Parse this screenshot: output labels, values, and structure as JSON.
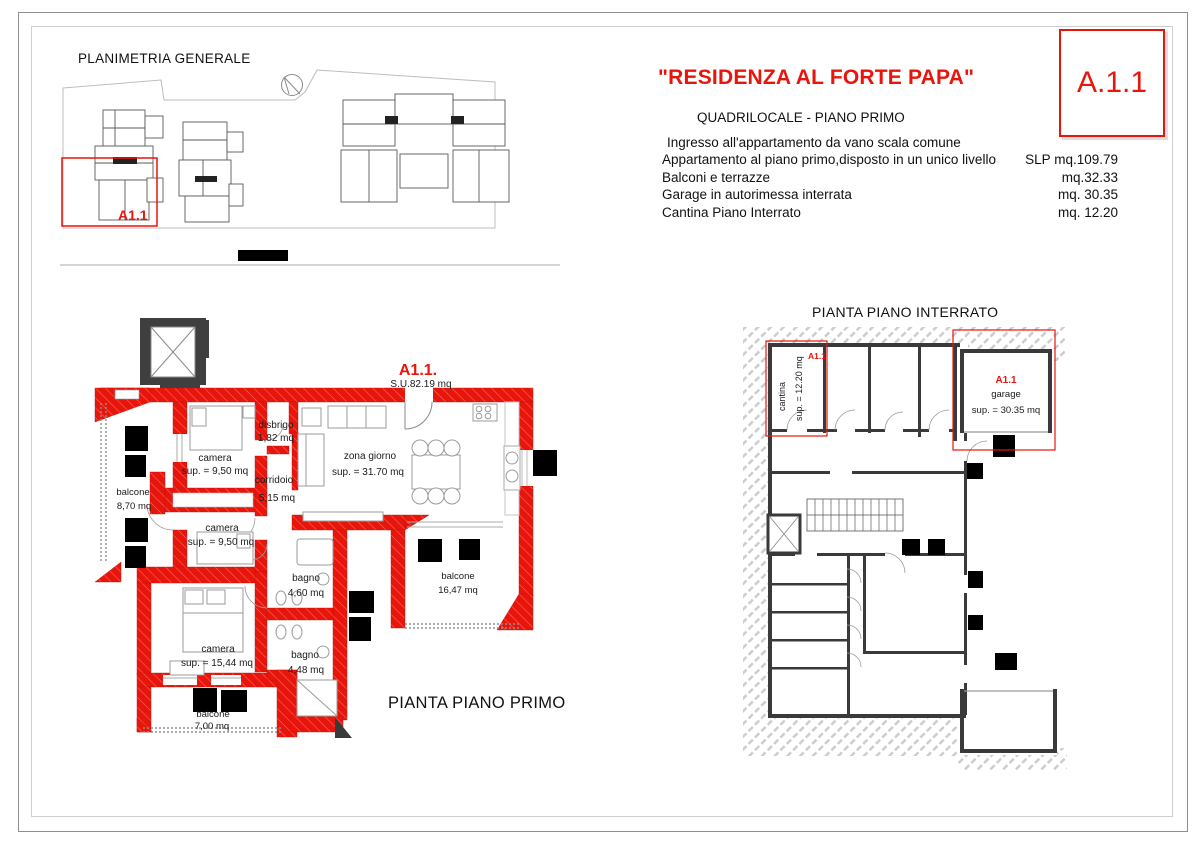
{
  "header": {
    "title": "\"RESIDENZA AL FORTE PAPA\"",
    "subtitle": "QUADRILOCALE - PIANO PRIMO",
    "unit_code": "A.1.1",
    "lines": [
      {
        "text": "Ingresso all'appartamento da vano scala comune",
        "value": ""
      },
      {
        "text": "Appartamento al piano primo,disposto in un unico livello",
        "value": "SLP mq.109.79"
      },
      {
        "text": "Balconi e terrazze",
        "value": "mq.32.33"
      },
      {
        "text": "Garage in autorimessa interrata",
        "value": "mq. 30.35"
      },
      {
        "text": "Cantina Piano Interrato",
        "value": "mq. 12.20"
      }
    ]
  },
  "site_plan": {
    "title": "PLANIMETRIA GENERALE",
    "unit_label": "A1.1"
  },
  "first_floor": {
    "title": "PIANTA PIANO PRIMO",
    "unit_label": "A1.1.",
    "unit_area": "S.U.82.19 mq",
    "rooms": {
      "camera1": {
        "name": "camera",
        "area": "sup. = 9,50 mq"
      },
      "camera2": {
        "name": "camera",
        "area": "sup. = 9,50 mq"
      },
      "camera3": {
        "name": "camera",
        "area": "sup. = 15,44 mq"
      },
      "disbrigo": {
        "name": "disbrigo",
        "area": "1,82 mq"
      },
      "corridoio": {
        "name": "corridoio",
        "area": "5,15 mq"
      },
      "zona_giorno": {
        "name": "zona giorno",
        "area": "sup. = 31.70 mq"
      },
      "bagno1": {
        "name": "bagno",
        "area": "4,60 mq"
      },
      "bagno2": {
        "name": "bagno",
        "area": "4,48 mq"
      },
      "balcone_ovest": {
        "name": "balcone",
        "area": "8,70 mq"
      },
      "balcone_sud": {
        "name": "balcone",
        "area": "7,00 mq"
      },
      "balcone_est": {
        "name": "balcone",
        "area": "16,47 mq"
      }
    }
  },
  "basement": {
    "title": "PIANTA PIANO INTERRATO",
    "cantina": {
      "label": "A1.1",
      "name": "cantina",
      "area": "sup. = 12.20 mq"
    },
    "garage": {
      "label": "A1.1",
      "name": "garage",
      "area": "sup. = 30.35 mq"
    }
  },
  "colors": {
    "accent_red": "#e8150c",
    "wall_dark": "#3a3a3a"
  }
}
